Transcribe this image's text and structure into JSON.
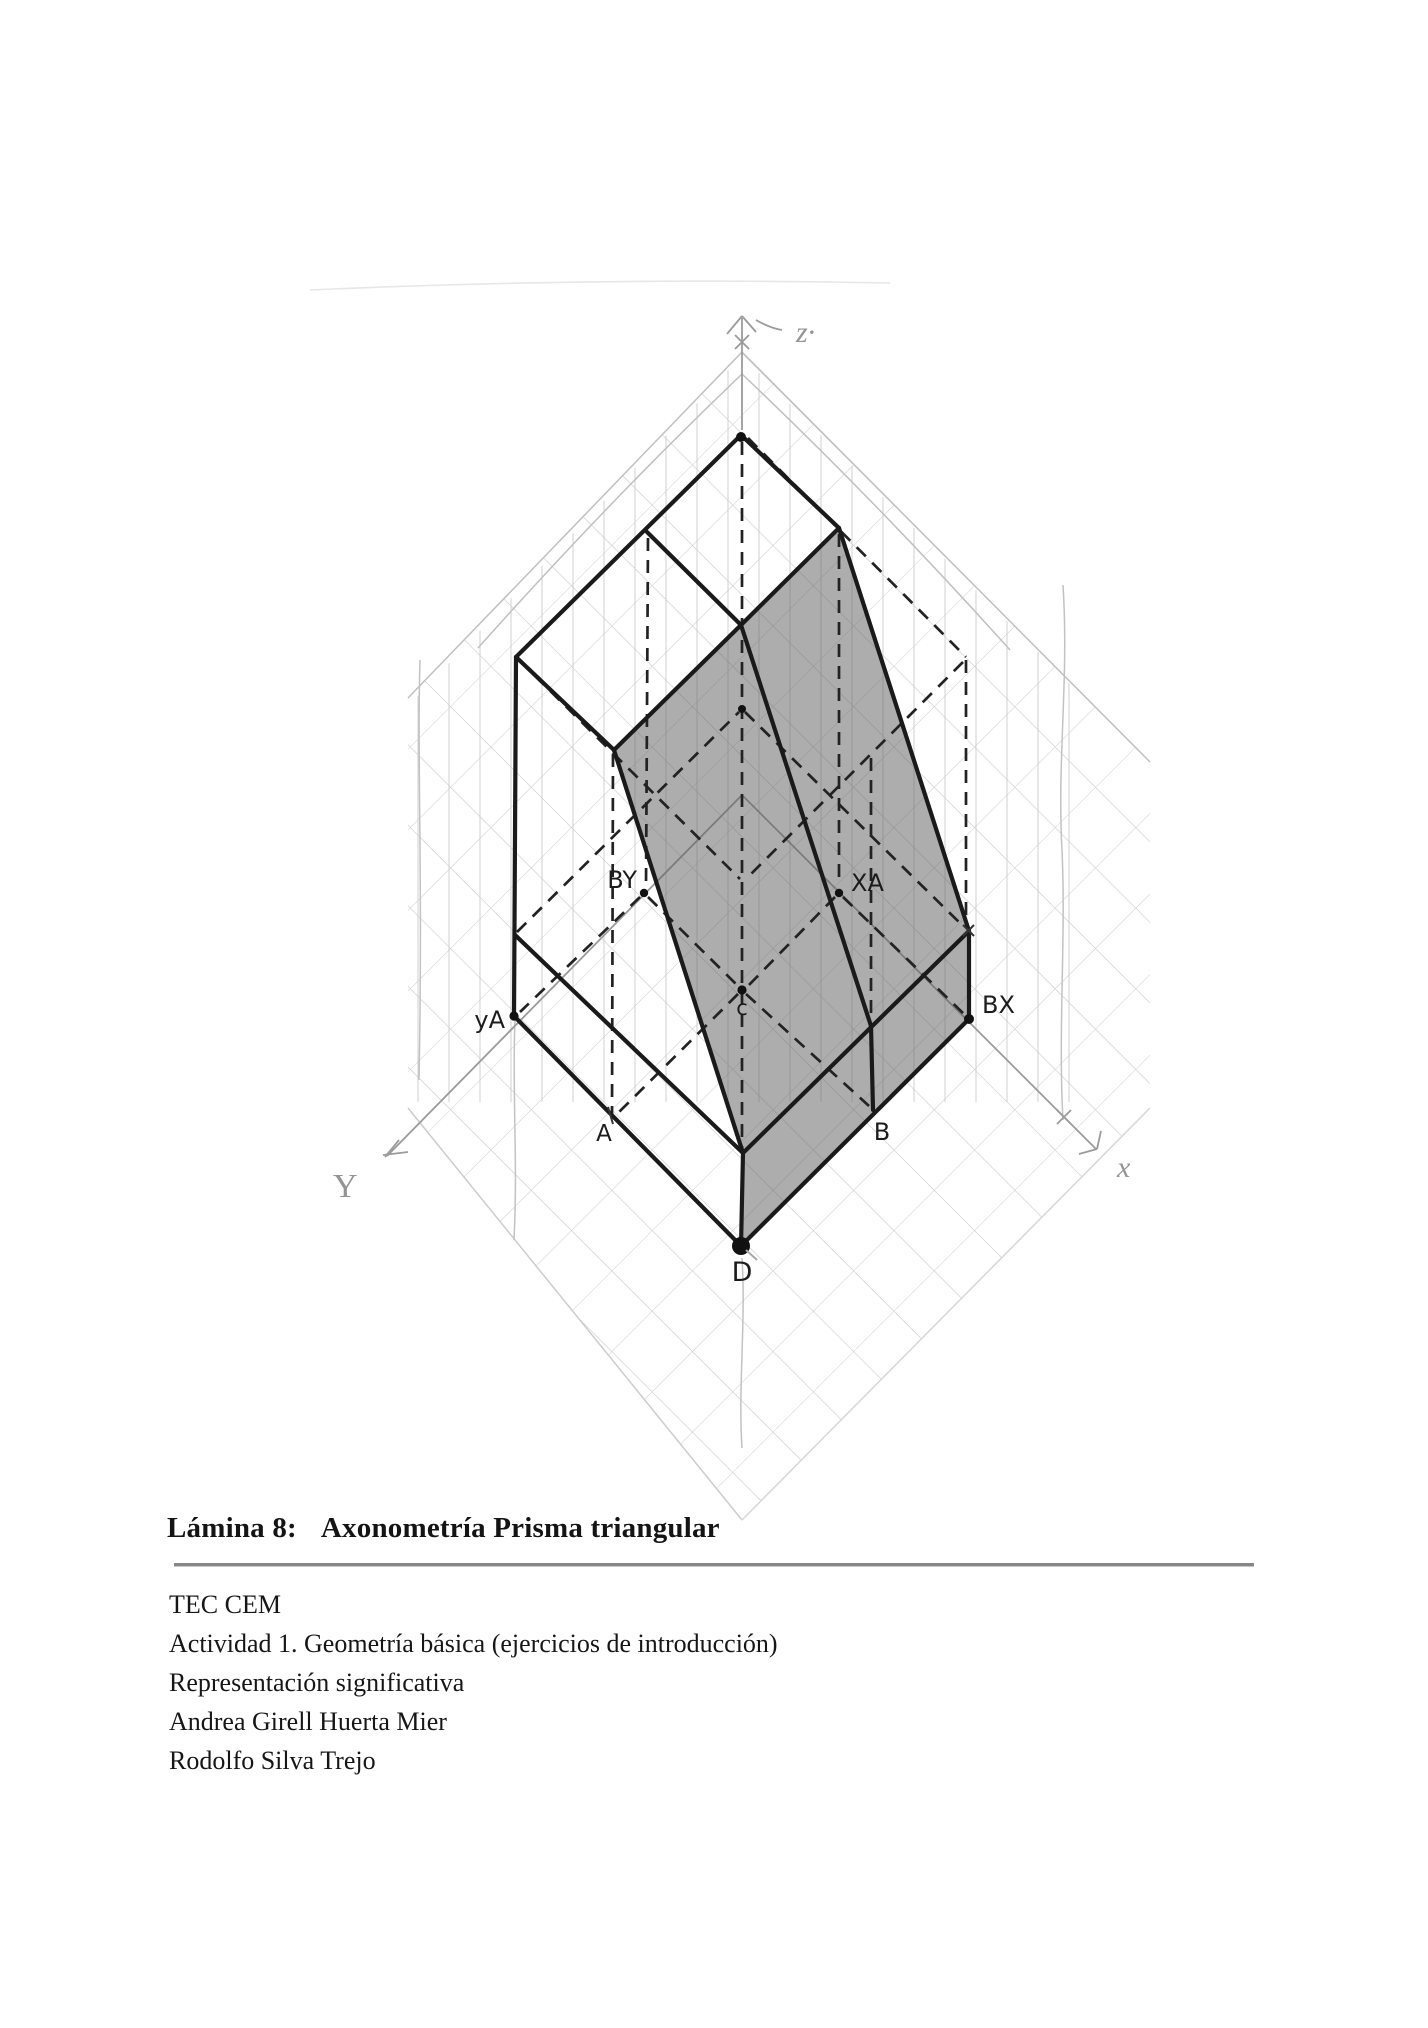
{
  "caption": {
    "label": "Lámina 8:",
    "title": "Axonometría Prisma triangular"
  },
  "details": {
    "lines": [
      "TEC CEM",
      "Actividad 1. Geometría básica (ejercicios de introducción)",
      "Representación significativa",
      "Andrea Girell Huerta Mier",
      "Rodolfo Silva Trejo"
    ]
  },
  "figure": {
    "description": "Hand-drawn axonometric (isometric) construction of a triangular prism on a pencil grid",
    "axis_labels": {
      "z": "z·",
      "y": "Y",
      "x": "x"
    },
    "point_labels": {
      "by": "BY",
      "xa": "XA",
      "c": "c",
      "ya": "yA",
      "bx": "BX",
      "a": "A",
      "b": "B",
      "d": "D"
    },
    "colors": {
      "ink": "#1a1a1a",
      "hidden_edge": "#222222",
      "shade": "rgba(92,92,92,0.5)",
      "pencil": "#bdbdbd",
      "pencil_dark": "#9b9b9b"
    }
  }
}
